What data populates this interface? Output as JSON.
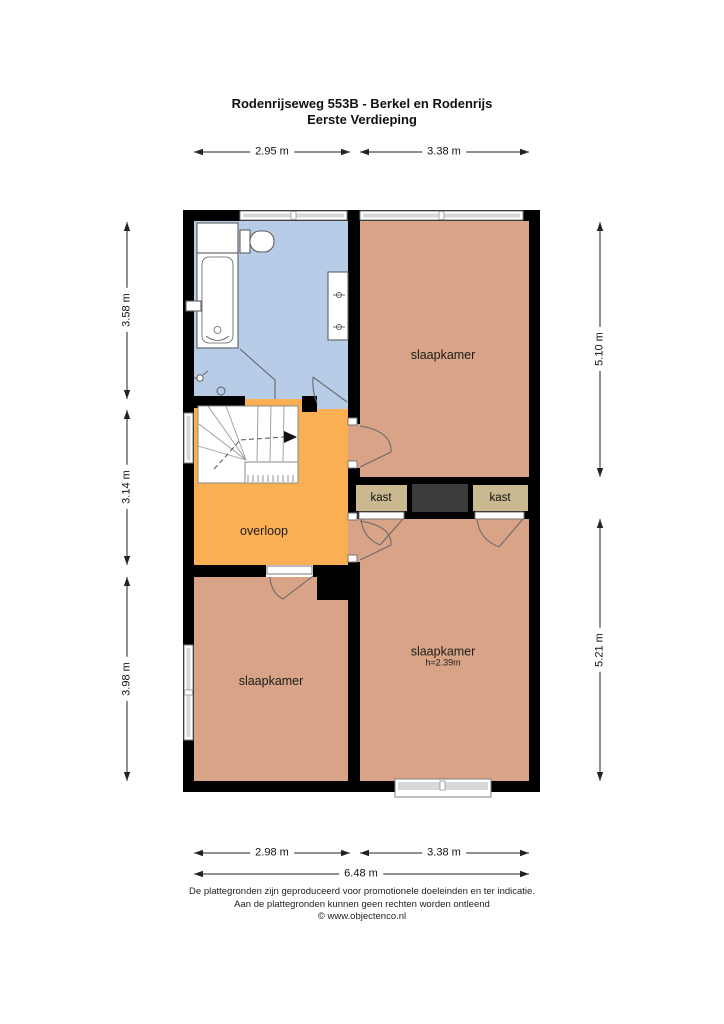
{
  "title": {
    "line1": "Rodenrijseweg 553B - Berkel en Rodenrijs",
    "line2": "Eerste Verdieping"
  },
  "dimensions": {
    "top_left": "2.95 m",
    "top_right": "3.38 m",
    "bottom_left": "2.98 m",
    "bottom_right": "3.38 m",
    "bottom_total": "6.48 m",
    "left_top": "3.58 m",
    "left_middle": "3.14 m",
    "left_bottom": "3.98 m",
    "right_top": "5.10 m",
    "right_bottom": "5.21 m"
  },
  "rooms": {
    "bedroom_top_right": {
      "label": "slaapkamer"
    },
    "bedroom_bottom_right": {
      "label": "slaapkamer",
      "ceiling_height": "h=2.39m"
    },
    "bedroom_bottom_left": {
      "label": "slaapkamer"
    },
    "landing": {
      "label": "overloop"
    },
    "closet_left": {
      "label": "kast"
    },
    "closet_right": {
      "label": "kast"
    }
  },
  "footer": {
    "line1": "De plattegronden zijn geproduceerd voor promotionele doeleinden en ter indicatie.",
    "line2": "Aan de plattegronden kunnen geen rechten worden ontleend",
    "line3": "© www.objectenco.nl"
  },
  "colors": {
    "bathroom": "#b7cde7",
    "bedroom": "#d9a387",
    "landing": "#fab052",
    "closet": "#c9b890",
    "closet_dark": "#3b3b3b",
    "wall": "#000000"
  }
}
